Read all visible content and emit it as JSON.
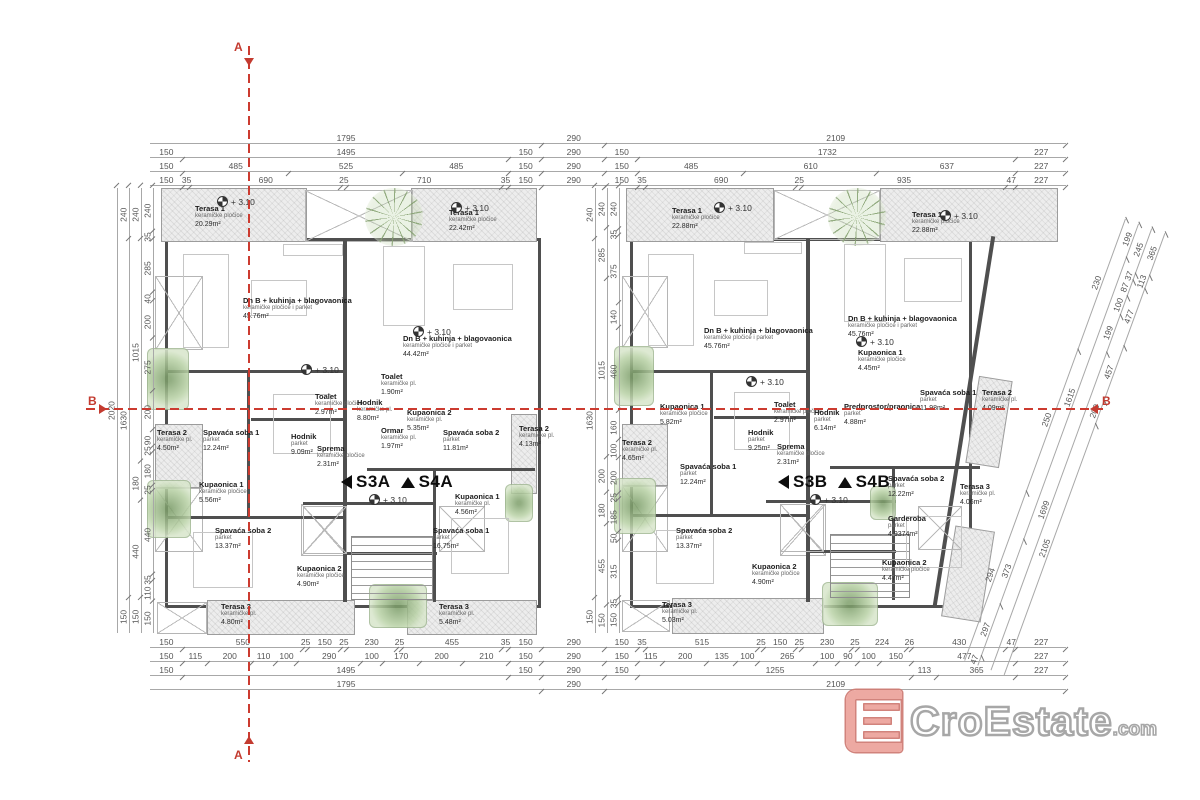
{
  "section_markers": {
    "a": "A",
    "b": "B"
  },
  "level_label": "+ 3.10",
  "logo": {
    "name": "CroEstate",
    "tld": ".com"
  },
  "plans": [
    {
      "units": {
        "left": "S3A",
        "right": "S4A"
      },
      "rooms": [
        {
          "name": "Terasa 1",
          "finish": "keramičke pločice",
          "area": "20.29m²",
          "x": 40,
          "y": 16
        },
        {
          "name": "Dn B + kuhinja + blagovaonica",
          "finish": "keramičke pločice i parket",
          "area": "45.76m²",
          "x": 88,
          "y": 108
        },
        {
          "name": "Terasa 2",
          "finish": "keramičke pl.",
          "area": "4.50m²",
          "x": 2,
          "y": 240
        },
        {
          "name": "Spavaća soba 1",
          "finish": "parket",
          "area": "12.24m²",
          "x": 48,
          "y": 240
        },
        {
          "name": "Kupaonica 1",
          "finish": "keramičke pločice",
          "area": "5.56m²",
          "x": 44,
          "y": 292
        },
        {
          "name": "Spavaća soba 2",
          "finish": "parket",
          "area": "13.37m²",
          "x": 60,
          "y": 338
        },
        {
          "name": "Kupaonica 2",
          "finish": "keramičke pločice",
          "area": "4.90m²",
          "x": 142,
          "y": 376
        },
        {
          "name": "Terasa 3",
          "finish": "keramičke pl.",
          "area": "4.80m²",
          "x": 66,
          "y": 414
        },
        {
          "name": "Hodnik",
          "finish": "parket",
          "area": "9.09m²",
          "x": 136,
          "y": 244
        },
        {
          "name": "Toalet",
          "finish": "keramičke pločice",
          "area": "2.97m²",
          "x": 160,
          "y": 204
        },
        {
          "name": "Sprema",
          "finish": "keramičke pločice",
          "area": "2.31m²",
          "x": 162,
          "y": 256
        },
        {
          "name": "Toalet",
          "finish": "keramičke pl.",
          "area": "1.90m²",
          "x": 226,
          "y": 184
        },
        {
          "name": "Hodnik",
          "finish": "keramičke pl.",
          "area": "8.80m²",
          "x": 202,
          "y": 210
        },
        {
          "name": "Kupaonica 2",
          "finish": "keramičke pl.",
          "area": "5.35m²",
          "x": 252,
          "y": 220
        },
        {
          "name": "Ormar",
          "finish": "keramičke pl.",
          "area": "1.97m²",
          "x": 226,
          "y": 238
        },
        {
          "name": "Spavaća soba 2",
          "finish": "parket",
          "area": "11.81m²",
          "x": 288,
          "y": 240
        },
        {
          "name": "Terasa 2",
          "finish": "keramičke pl.",
          "area": "4.13m²",
          "x": 364,
          "y": 236
        },
        {
          "name": "Kupaonica 1",
          "finish": "keramičke pl.",
          "area": "4.56m²",
          "x": 300,
          "y": 304
        },
        {
          "name": "Spavaća soba 1",
          "finish": "parket",
          "area": "16.75m²",
          "x": 278,
          "y": 338
        },
        {
          "name": "Terasa 3",
          "finish": "keramičke pl.",
          "area": "5.48m²",
          "x": 284,
          "y": 414
        },
        {
          "name": "Terasa 1",
          "finish": "keramičke pločice",
          "area": "22.42m²",
          "x": 294,
          "y": 20
        },
        {
          "name": "Dn B + kuhinja + blagovaonica",
          "finish": "keramičke pločice i parket",
          "area": "44.42m²",
          "x": 248,
          "y": 146
        }
      ]
    },
    {
      "units": {
        "left": "S3B",
        "right": "S4B"
      },
      "rooms": [
        {
          "name": "Terasa 1",
          "finish": "keramičke pločice",
          "area": "22.88m²",
          "x": 50,
          "y": 18
        },
        {
          "name": "Dn B + kuhinja + blagovaonica",
          "finish": "keramičke pločice i parket",
          "area": "45.76m²",
          "x": 82,
          "y": 138
        },
        {
          "name": "Kupaonica 1",
          "finish": "keramičke pločice",
          "area": "5.82m²",
          "x": 38,
          "y": 214
        },
        {
          "name": "Terasa 2",
          "finish": "keramičke pl.",
          "area": "4.65m²",
          "x": 0,
          "y": 250
        },
        {
          "name": "Spavaća soba 1",
          "finish": "parket",
          "area": "12.24m²",
          "x": 58,
          "y": 274
        },
        {
          "name": "Hodnik",
          "finish": "parket",
          "area": "9.25m²",
          "x": 126,
          "y": 240
        },
        {
          "name": "Toalet",
          "finish": "keramičke pločice",
          "area": "2.97m²",
          "x": 152,
          "y": 212
        },
        {
          "name": "Sprema",
          "finish": "keramičke pločice",
          "area": "2.31m²",
          "x": 155,
          "y": 254
        },
        {
          "name": "Spavaća soba 2",
          "finish": "parket",
          "area": "13.37m²",
          "x": 54,
          "y": 338
        },
        {
          "name": "Kupaonica 2",
          "finish": "keramičke pločice",
          "area": "4.90m²",
          "x": 130,
          "y": 374
        },
        {
          "name": "Terasa 3",
          "finish": "keramičke pl.",
          "area": "5.03m²",
          "x": 40,
          "y": 412
        },
        {
          "name": "Hodnik",
          "finish": "parket",
          "area": "6.14m²",
          "x": 192,
          "y": 220
        },
        {
          "name": "Terasa 1",
          "finish": "keramičke pločice",
          "area": "22.88m²",
          "x": 290,
          "y": 22
        },
        {
          "name": "Dn B + kuhinja + blagovaonica",
          "finish": "keramičke pločice i parket",
          "area": "45.76m²",
          "x": 226,
          "y": 126
        },
        {
          "name": "Kupaonica 1",
          "finish": "keramičke pločice",
          "area": "4.45m²",
          "x": 236,
          "y": 160
        },
        {
          "name": "Predprostor/praonica",
          "finish": "parket",
          "area": "4.88m²",
          "x": 222,
          "y": 214
        },
        {
          "name": "Spavaća soba 1",
          "finish": "parket",
          "area": "11.98m²",
          "x": 298,
          "y": 200
        },
        {
          "name": "Terasa 2",
          "finish": "keramičke pl.",
          "area": "4.09m²",
          "x": 360,
          "y": 200
        },
        {
          "name": "Spavaća soba 2",
          "finish": "parket",
          "area": "12.22m²",
          "x": 266,
          "y": 286
        },
        {
          "name": "Terasa 3",
          "finish": "keramičke pl.",
          "area": "4.06m²",
          "x": 338,
          "y": 294
        },
        {
          "name": "Garderoba",
          "finish": "parket",
          "area": "4.9374m²",
          "x": 266,
          "y": 326
        },
        {
          "name": "Kupaonica 2",
          "finish": "keramičke pločice",
          "area": "4.47m²",
          "x": 260,
          "y": 370
        }
      ]
    }
  ],
  "level_positions": [
    [
      [
        62,
        8
      ],
      [
        296,
        14
      ],
      [
        258,
        138
      ],
      [
        146,
        176
      ],
      [
        214,
        306
      ]
    ],
    [
      [
        92,
        14
      ],
      [
        318,
        22
      ],
      [
        234,
        148
      ],
      [
        124,
        188
      ],
      [
        188,
        306
      ]
    ]
  ],
  "dimensions": {
    "top_rows": [
      [
        "1795",
        "290",
        "2109"
      ],
      [
        "150",
        "1495",
        "150",
        "290",
        "150",
        "1732",
        "227"
      ],
      [
        "150",
        "485",
        "525",
        "485",
        "150",
        "290",
        "150",
        "485",
        "610",
        "637",
        "227"
      ],
      [
        "150",
        "35",
        "690",
        "25",
        "710",
        "35",
        "150",
        "290",
        "150",
        "35",
        "690",
        "25",
        "935",
        "47",
        "227"
      ]
    ],
    "bottom_rows": [
      [
        "150",
        "550",
        "25",
        "150",
        "25",
        "230",
        "25",
        "455",
        "35",
        "150",
        "290",
        "150",
        "35",
        "515",
        "25",
        "150",
        "25",
        "230",
        "25",
        "224",
        "26",
        "430",
        "47",
        "227"
      ],
      [
        "150",
        "115",
        "200",
        "110",
        "100",
        "290",
        "100",
        "170",
        "200",
        "210",
        "150",
        "290",
        "150",
        "115",
        "200",
        "135",
        "100",
        "265",
        "100",
        "90",
        "100",
        "150",
        "477",
        "227"
      ],
      [
        "150",
        "1495",
        "150",
        "290",
        "150",
        "1255",
        "113",
        "365",
        "227"
      ],
      [
        "1795",
        "290",
        "2109"
      ]
    ],
    "left_cols": [
      [
        "2020"
      ],
      [
        "240",
        "1630",
        "150"
      ],
      [
        "240",
        "1015",
        "180",
        "440",
        "150"
      ],
      [
        "240",
        "35",
        "285",
        "40",
        "200",
        "275",
        "200",
        "90",
        "25",
        "180",
        "25",
        "440",
        "35",
        "110",
        "150"
      ]
    ],
    "mid_cols": [
      [
        "240",
        "1630",
        "150"
      ],
      [
        "240",
        "285",
        "1015",
        "200",
        "180",
        "455",
        "150"
      ],
      [
        "240",
        "35",
        "375",
        "140",
        "460",
        "160",
        "100",
        "200",
        "25",
        "185",
        "50",
        "315",
        "35",
        "150"
      ]
    ],
    "diag_rows": [
      [
        "294",
        "250",
        "230"
      ],
      [
        "47",
        "297",
        "373",
        "1615",
        "199"
      ],
      [
        "1699",
        "199",
        "100",
        "87",
        "37",
        "245"
      ],
      [
        "2105",
        "200",
        "457",
        "477",
        "113",
        "365"
      ]
    ]
  }
}
